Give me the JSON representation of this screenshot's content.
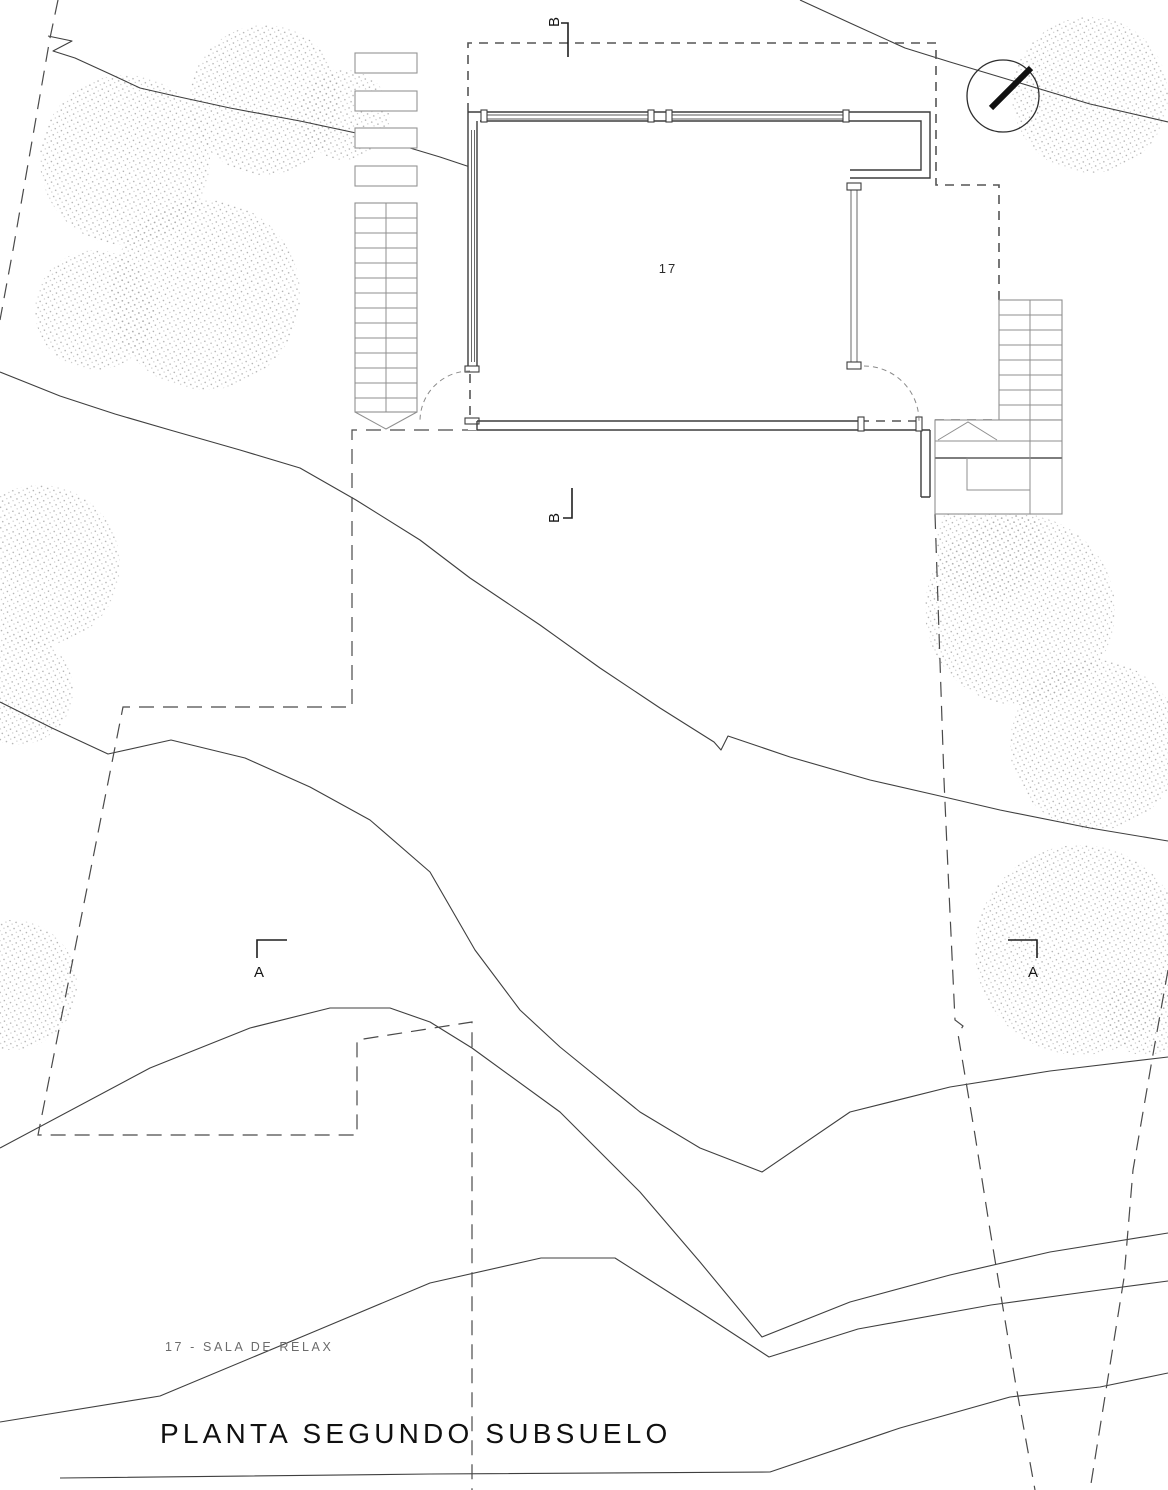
{
  "drawing": {
    "type": "architectural-floor-plan",
    "room": {
      "number": "17"
    },
    "legend": {
      "text": "17 - SALA DE RELAX"
    },
    "title": {
      "text": "PLANTA SEGUNDO SUBSUELO"
    },
    "section_markers": {
      "a": "A",
      "b": "B"
    },
    "colors": {
      "paper": "#ffffff",
      "ink": "#1a1a1a",
      "wall": "#3d3d3d",
      "window": "#5a5a5a",
      "stair": "#8f8f8f",
      "contour": "#3f3f3f",
      "boundary": "#4a4a4a",
      "stipple": "#adadad",
      "legend_text": "#6b6b6b"
    }
  }
}
